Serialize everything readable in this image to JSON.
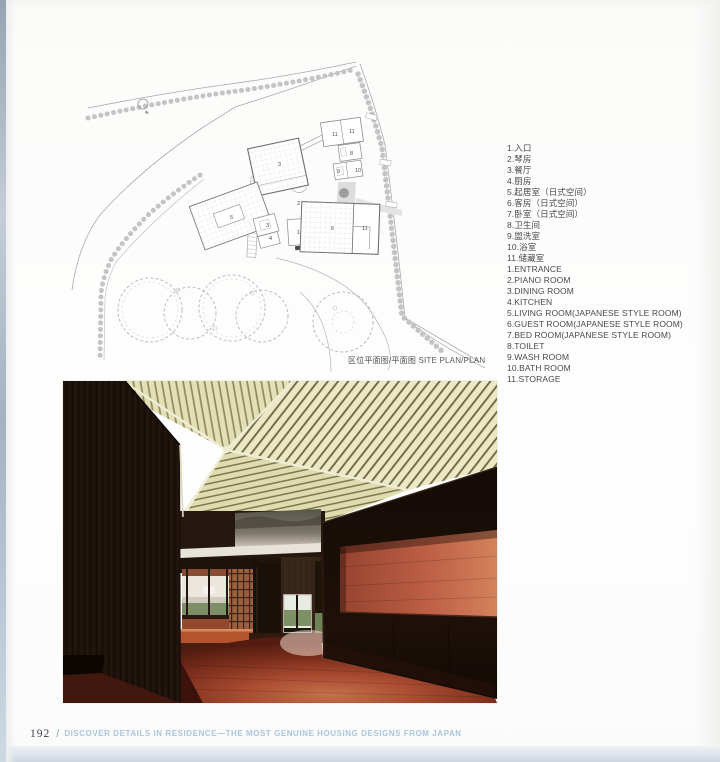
{
  "page": {
    "number": "192",
    "separator": "/",
    "footer_title": "DISCOVER DETAILS IN RESIDENCE—THE MOST GENUINE HOUSING DESIGNS FROM JAPAN"
  },
  "plan": {
    "caption_cn": "区位平面图/平面图",
    "caption_en": "SITE PLAN/PLAN",
    "north_mark": "N",
    "labels": [
      {
        "n": "11",
        "x": 302,
        "y": 86
      },
      {
        "n": "11",
        "x": 319,
        "y": 83
      },
      {
        "n": "8",
        "x": 320,
        "y": 105
      },
      {
        "n": "9",
        "x": 307,
        "y": 123
      },
      {
        "n": "10",
        "x": 325,
        "y": 122
      },
      {
        "n": "3",
        "x": 248,
        "y": 116
      },
      {
        "n": "2",
        "x": 267,
        "y": 155
      },
      {
        "n": "5",
        "x": 200,
        "y": 169
      },
      {
        "n": "3",
        "x": 236,
        "y": 177
      },
      {
        "n": "4",
        "x": 239,
        "y": 190
      },
      {
        "n": "1",
        "x": 267,
        "y": 184
      },
      {
        "n": "6",
        "x": 301,
        "y": 180
      },
      {
        "n": "11",
        "x": 332,
        "y": 180
      }
    ]
  },
  "legend": {
    "chinese": [
      "1.入口",
      "2.琴房",
      "3.餐厅",
      "4.厨房",
      "5.起居室（日式空间）",
      "6.客房（日式空间）",
      "7.卧室（日式空间）",
      "8.卫生间",
      "9.盥洗室",
      "10.浴室",
      "11.储藏室"
    ],
    "english": [
      "1.ENTRANCE",
      "2.PIANO ROOM",
      "3.DINING ROOM",
      "4.KITCHEN",
      "5.LIVING ROOM(JAPANESE STYLE ROOM)",
      "6.GUEST ROOM(JAPANESE STYLE ROOM)",
      "7.BED ROOM(JAPANESE STYLE ROOM)",
      "8.TOILET",
      "9.WASH ROOM",
      "10.BATH ROOM",
      "11.STORAGE"
    ]
  },
  "palette": {
    "footer-blue": "#a9c6dc",
    "page-number": "#3f4150",
    "band-bottom": "#ccd6e2",
    "plan-line": "#a8a8a8",
    "ceiling-cream": "#e9e5c0",
    "wood-dark": "#1b110b",
    "floor-red": "#b25339",
    "niche-red": "#bc5f45"
  }
}
